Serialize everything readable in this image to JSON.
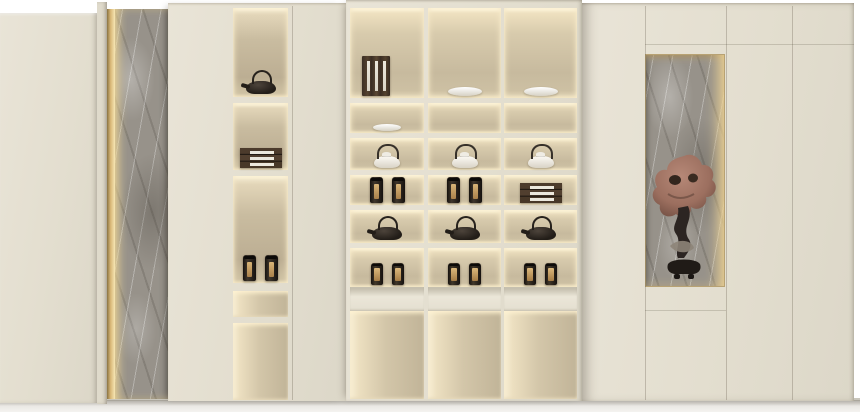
{
  "scene": {
    "description": "Beige built-in wall cabinet with warm LED-illuminated display niches, a backlit gray marble accent column, tea ware styling and a driftwood root sculpture niche",
    "colors": {
      "cabinet_cream": "#e3decf",
      "niche_warm_light": "#f7ecd0",
      "niche_shadow": "#c2b59a",
      "led_gold": "#e7c98b",
      "marble_gray": "#97928a",
      "item_dark_lacquer": "#2e2822",
      "label_gold": "#c8a468",
      "porcelain_white": "#f6f4ee",
      "floor": "#f2f1ed"
    }
  },
  "tower": {
    "niches": [
      [
        "dark-teapot"
      ],
      [
        "box-stack"
      ],
      [
        "caddy",
        "caddy"
      ],
      [],
      []
    ]
  },
  "center_unit": {
    "r1": [
      [
        "book-stack"
      ],
      [
        "white-bowl"
      ],
      [
        "white-bowl"
      ]
    ],
    "r2": [
      [
        "white-dish"
      ],
      [],
      []
    ],
    "r3": [
      [
        "white-teapot"
      ],
      [
        "white-teapot"
      ],
      [
        "white-teapot"
      ]
    ],
    "r4": [
      [
        "caddy",
        "caddy"
      ],
      [
        "caddy",
        "caddy"
      ],
      [
        "box-stack"
      ]
    ],
    "r5": [
      [
        "dark-teapot"
      ],
      [
        "dark-teapot"
      ],
      [
        "dark-teapot"
      ]
    ],
    "r6": [
      [
        "caddy-gold",
        "caddy-gold"
      ],
      [
        "caddy-gold",
        "caddy-gold"
      ],
      [
        "caddy-gold",
        "caddy-gold"
      ]
    ],
    "r7": [
      [],
      [],
      []
    ]
  },
  "right_cabinet": {
    "niche_contents": "driftwood-root-sculpture-on-stand",
    "back_material": "gray-marble",
    "edge_light": "vertical-gold-led"
  }
}
